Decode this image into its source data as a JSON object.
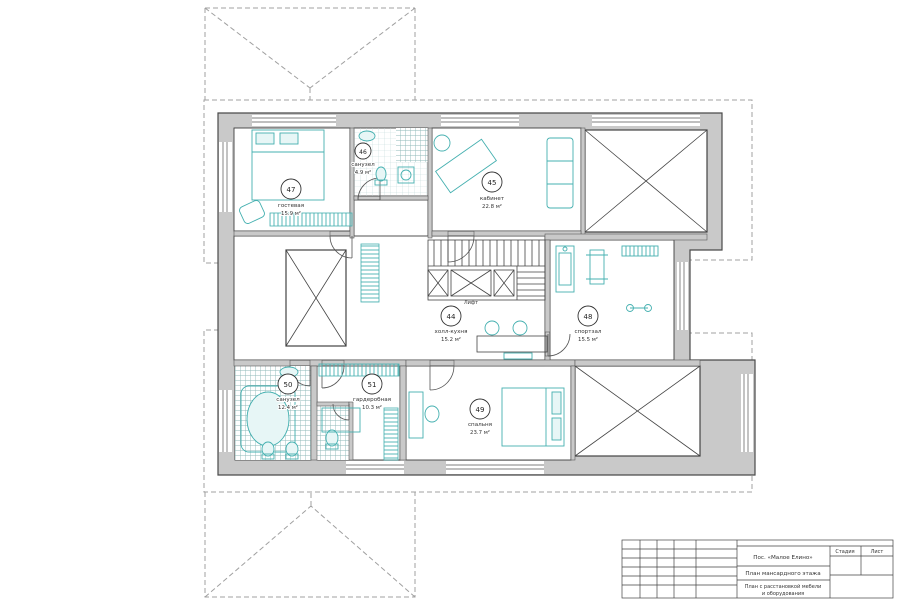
{
  "page": {
    "background": "#ffffff"
  },
  "plan": {
    "type": "floor-plan",
    "rooms": {
      "r44": {
        "number": "44",
        "name": "холл-кухня",
        "area": "15.2 м²"
      },
      "r45": {
        "number": "45",
        "name": "кабинет",
        "area": "22.8 м²"
      },
      "r46": {
        "number": "46",
        "name": "санузел",
        "area": "4.9 м²"
      },
      "r47": {
        "number": "47",
        "name": "гостевая",
        "area": "15.9 м²"
      },
      "r48": {
        "number": "48",
        "name": "спортзал",
        "area": "15.5 м²"
      },
      "r49": {
        "number": "49",
        "name": "спальня",
        "area": "23.7 м²"
      },
      "r50": {
        "number": "50",
        "name": "санузел",
        "area": "12.4 м²"
      },
      "r51": {
        "number": "51",
        "name": "гардеробная",
        "area": "10.3 м²"
      }
    },
    "labels": {
      "lift": "Лифт"
    }
  },
  "title_block": {
    "project": "Пос. «Малое Елино»",
    "drawing_title": "План мансардного этажа",
    "sheet_title_line1": "План с расстановкой мебели",
    "sheet_title_line2": "и оборудования",
    "stage_header": "Стадия",
    "sheet_header": "Лист"
  },
  "colors": {
    "wall_fill": "#c9c9c9",
    "wall_stroke": "#4a4a4a",
    "furniture": "#45b0b0",
    "dashed_outline": "#a0a0a0",
    "background": "#ffffff"
  }
}
